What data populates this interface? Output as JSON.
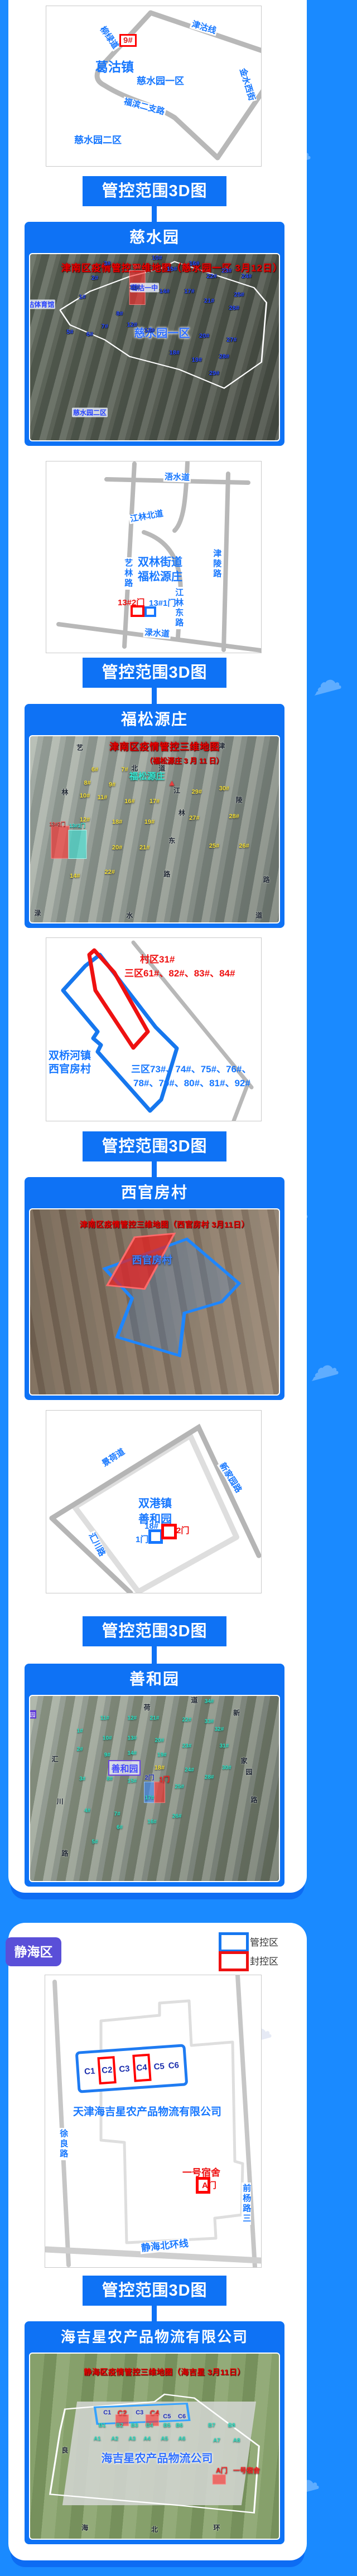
{
  "banner_label": "管控范围3D图",
  "watermark_text": "津云",
  "jinghai": {
    "badge": "静海区",
    "legend": [
      {
        "label": "管控区",
        "color": "#1677f0"
      },
      {
        "label": "封控区",
        "color": "#ee1111"
      }
    ]
  },
  "map1": {
    "marker": "9#",
    "town": "葛沽镇",
    "area1": "慈水园一区",
    "area2": "慈水园二区",
    "road_liulv": "柳绿道",
    "road_jingu": "津沽线",
    "road_jinshui": "金水西街",
    "road_fubin": "福滨二支路"
  },
  "sat1": {
    "title": "慈水园",
    "marks": [
      {
        "t": "津南区疫情管控三维地图（慈水园一区 3月12日）",
        "x": 57,
        "y": 7,
        "c": "headline"
      },
      {
        "t": "",
        "x": 43,
        "y": 18,
        "w": 6,
        "h": 18,
        "c": "hl-red"
      },
      {
        "t": "9#",
        "x": 43,
        "y": 7,
        "c": "num-red"
      },
      {
        "t": "葛沽一中",
        "x": 46,
        "y": 18,
        "c": "tag-blue"
      },
      {
        "t": "葛沽体育馆",
        "x": 3,
        "y": 27,
        "c": "tag-blue"
      },
      {
        "t": "慈水园一区",
        "x": 53,
        "y": 42,
        "c": "big-blue"
      },
      {
        "t": "慈水园二区",
        "x": 24,
        "y": 85,
        "c": "tag-blue"
      },
      {
        "t": "1#",
        "x": 21,
        "y": 23,
        "c": "num-blue"
      },
      {
        "t": "2#",
        "x": 26,
        "y": 13,
        "c": "num-blue"
      },
      {
        "t": "3#",
        "x": 31,
        "y": 5,
        "c": "num-blue"
      },
      {
        "t": "5#",
        "x": 16,
        "y": 42,
        "c": "num-blue"
      },
      {
        "t": "6#",
        "x": 24,
        "y": 43,
        "c": "num-blue"
      },
      {
        "t": "7#",
        "x": 30,
        "y": 39,
        "c": "num-blue"
      },
      {
        "t": "8#",
        "x": 36,
        "y": 32,
        "c": "num-blue"
      },
      {
        "t": "10#",
        "x": 51,
        "y": 2,
        "c": "num-blue"
      },
      {
        "t": "11#",
        "x": 42,
        "y": 18,
        "c": "num-blue"
      },
      {
        "t": "12#",
        "x": 41,
        "y": 38,
        "c": "num-blue"
      },
      {
        "t": "13#",
        "x": 48,
        "y": 41,
        "c": "num-blue"
      },
      {
        "t": "14#",
        "x": 54,
        "y": 20,
        "c": "num-blue"
      },
      {
        "t": "15#",
        "x": 57,
        "y": 8,
        "c": "num-blue"
      },
      {
        "t": "16#",
        "x": 66,
        "y": 5,
        "c": "num-blue"
      },
      {
        "t": "17#",
        "x": 64,
        "y": 20,
        "c": "num-blue"
      },
      {
        "t": "18#",
        "x": 58,
        "y": 53,
        "c": "num-blue"
      },
      {
        "t": "19#",
        "x": 67,
        "y": 57,
        "c": "num-blue"
      },
      {
        "t": "20#",
        "x": 70,
        "y": 44,
        "c": "num-blue"
      },
      {
        "t": "21#",
        "x": 72,
        "y": 25,
        "c": "num-blue"
      },
      {
        "t": "22#",
        "x": 73,
        "y": 12,
        "c": "num-blue"
      },
      {
        "t": "23#",
        "x": 79,
        "y": 9,
        "c": "num-blue"
      },
      {
        "t": "24#",
        "x": 87,
        "y": 12,
        "c": "num-blue"
      },
      {
        "t": "25#",
        "x": 84,
        "y": 22,
        "c": "num-blue"
      },
      {
        "t": "26#",
        "x": 82,
        "y": 29,
        "c": "num-blue"
      },
      {
        "t": "27#",
        "x": 81,
        "y": 46,
        "c": "num-blue"
      },
      {
        "t": "28#",
        "x": 78,
        "y": 55,
        "c": "num-blue"
      },
      {
        "t": "29#",
        "x": 74,
        "y": 64,
        "c": "num-blue"
      }
    ]
  },
  "map2": {
    "road_wushui": "浯水道",
    "road_yilin": "艺林路",
    "road_jinling": "津陵路",
    "road_jldong": "江林东路",
    "road_jlbei": "江林北道",
    "road_lushui": "渌水道",
    "name1": "双林街道",
    "name2": "福松源庄",
    "gate2": "13#2门",
    "gate1": "13#1门"
  },
  "sat2": {
    "title": "福松源庄",
    "marks": [
      {
        "t": "津南区疫情管控三维地图",
        "x": 54,
        "y": 5,
        "c": "headline"
      },
      {
        "t": "（福松源庄 3 月 11 日）",
        "x": 62,
        "y": 13,
        "c": "headline2"
      },
      {
        "t": "福松源庄",
        "x": 47,
        "y": 21,
        "c": "big-teal"
      },
      {
        "t": "",
        "x": 12,
        "y": 57,
        "w": 7,
        "h": 17,
        "c": "hl-red"
      },
      {
        "t": "",
        "x": 19,
        "y": 58,
        "w": 7,
        "h": 15,
        "c": "hl-cyan"
      },
      {
        "t": "13#2门",
        "x": 11,
        "y": 47,
        "c": "tiny-red"
      },
      {
        "t": "13#1门",
        "x": 19,
        "y": 48,
        "c": "tiny-cyan"
      },
      {
        "t": "6#",
        "x": 26,
        "y": 18,
        "c": "num-yellow"
      },
      {
        "t": "7#",
        "x": 38,
        "y": 18,
        "c": "num-yellow"
      },
      {
        "t": "8#",
        "x": 23,
        "y": 25,
        "c": "num-yellow"
      },
      {
        "t": "9#",
        "x": 33,
        "y": 26,
        "c": "num-yellow"
      },
      {
        "t": "10#",
        "x": 22,
        "y": 32,
        "c": "num-yellow"
      },
      {
        "t": "11#",
        "x": 29,
        "y": 33,
        "c": "num-yellow"
      },
      {
        "t": "16#",
        "x": 40,
        "y": 35,
        "c": "num-yellow"
      },
      {
        "t": "17#",
        "x": 50,
        "y": 35,
        "c": "num-yellow"
      },
      {
        "t": "29#",
        "x": 67,
        "y": 30,
        "c": "num-yellow"
      },
      {
        "t": "30#",
        "x": 78,
        "y": 28,
        "c": "num-yellow"
      },
      {
        "t": "12#",
        "x": 22,
        "y": 45,
        "c": "num-yellow"
      },
      {
        "t": "18#",
        "x": 35,
        "y": 46,
        "c": "num-yellow"
      },
      {
        "t": "19#",
        "x": 48,
        "y": 46,
        "c": "num-yellow"
      },
      {
        "t": "27#",
        "x": 66,
        "y": 44,
        "c": "num-yellow"
      },
      {
        "t": "28#",
        "x": 82,
        "y": 43,
        "c": "num-yellow"
      },
      {
        "t": "20#",
        "x": 35,
        "y": 60,
        "c": "num-yellow"
      },
      {
        "t": "21#",
        "x": 46,
        "y": 60,
        "c": "num-yellow"
      },
      {
        "t": "25#",
        "x": 74,
        "y": 59,
        "c": "num-yellow"
      },
      {
        "t": "26#",
        "x": 86,
        "y": 59,
        "c": "num-yellow"
      },
      {
        "t": "22#",
        "x": 32,
        "y": 73,
        "c": "num-yellow"
      },
      {
        "t": "14#",
        "x": 18,
        "y": 75,
        "c": "num-yellow"
      },
      {
        "t": "艺",
        "x": 20,
        "y": 6,
        "c": "rchar"
      },
      {
        "t": "林",
        "x": 14,
        "y": 30,
        "c": "rchar"
      },
      {
        "t": "北",
        "x": 42,
        "y": 17,
        "c": "rchar"
      },
      {
        "t": "道",
        "x": 53,
        "y": 17,
        "c": "rchar"
      },
      {
        "t": "江",
        "x": 59,
        "y": 29,
        "c": "rchar"
      },
      {
        "t": "林",
        "x": 61,
        "y": 41,
        "c": "rchar"
      },
      {
        "t": "东",
        "x": 57,
        "y": 56,
        "c": "rchar"
      },
      {
        "t": "路",
        "x": 55,
        "y": 74,
        "c": "rchar"
      },
      {
        "t": "津",
        "x": 77,
        "y": 5,
        "c": "rchar"
      },
      {
        "t": "陵",
        "x": 84,
        "y": 34,
        "c": "rchar"
      },
      {
        "t": "路",
        "x": 95,
        "y": 77,
        "c": "rchar"
      },
      {
        "t": "渌",
        "x": 3,
        "y": 95,
        "c": "rchar"
      },
      {
        "t": "水",
        "x": 40,
        "y": 96,
        "c": "rchar"
      },
      {
        "t": "道",
        "x": 92,
        "y": 96,
        "c": "rchar"
      }
    ]
  },
  "map3": {
    "red1": "村区31#",
    "red2": "三区61#、82#、83#、84#",
    "name1": "双桥河镇",
    "name2": "西官房村",
    "blue1": "三区73#、74#、75#、76#、",
    "blue2": "78#、79#、80#、81#、92#"
  },
  "sat3": {
    "title": "西官房村",
    "marks": [
      {
        "t": "津南区疫情管控三维地图（西官房村 3月11日）",
        "x": 54,
        "y": 8,
        "c": "headline-sm"
      },
      {
        "t": "西官房村",
        "x": 49,
        "y": 27,
        "c": "big-blue2"
      }
    ]
  },
  "map4": {
    "road_jinghe": "景荷道",
    "road_xinjiayuan": "新家园路",
    "road_huichuan": "汇川路",
    "name1": "双港镇",
    "name2": "善和园",
    "bldg": "18#",
    "gate1": "1门",
    "gate2": "2门"
  },
  "sat4": {
    "title": "善和园",
    "marks": [
      {
        "t": "园",
        "x": 1,
        "y": 10,
        "c": "tag-purple"
      },
      {
        "t": "善和园",
        "x": 38,
        "y": 39,
        "c": "big-purple"
      },
      {
        "t": "18#",
        "x": 52,
        "y": 39,
        "c": "num-yellow"
      },
      {
        "t": "",
        "x": 48,
        "y": 52,
        "w": 4,
        "h": 11,
        "c": "hl-blue"
      },
      {
        "t": "",
        "x": 52,
        "y": 52,
        "w": 4,
        "h": 11,
        "c": "hl-red"
      },
      {
        "t": "2门",
        "x": 48,
        "y": 44,
        "c": "num-navy"
      },
      {
        "t": "1门",
        "x": 54,
        "y": 45,
        "c": "num-redsm"
      },
      {
        "t": "1#",
        "x": 20,
        "y": 19,
        "c": "num-teal"
      },
      {
        "t": "2#",
        "x": 20,
        "y": 29,
        "c": "num-teal"
      },
      {
        "t": "3#",
        "x": 21,
        "y": 45,
        "c": "num-teal"
      },
      {
        "t": "4#",
        "x": 23,
        "y": 62,
        "c": "num-teal"
      },
      {
        "t": "5#",
        "x": 26,
        "y": 79,
        "c": "num-teal"
      },
      {
        "t": "6#",
        "x": 36,
        "y": 71,
        "c": "num-teal"
      },
      {
        "t": "7#",
        "x": 35,
        "y": 64,
        "c": "num-teal"
      },
      {
        "t": "8#",
        "x": 32,
        "y": 45,
        "c": "num-teal"
      },
      {
        "t": "9#",
        "x": 31,
        "y": 32,
        "c": "num-teal"
      },
      {
        "t": "10#",
        "x": 31,
        "y": 23,
        "c": "num-teal"
      },
      {
        "t": "11#",
        "x": 30,
        "y": 12,
        "c": "num-teal"
      },
      {
        "t": "12#",
        "x": 41,
        "y": 12,
        "c": "num-teal"
      },
      {
        "t": "13#",
        "x": 41,
        "y": 23,
        "c": "num-teal"
      },
      {
        "t": "14#",
        "x": 41,
        "y": 31,
        "c": "num-teal"
      },
      {
        "t": "15#",
        "x": 41,
        "y": 46,
        "c": "num-teal"
      },
      {
        "t": "16#",
        "x": 49,
        "y": 68,
        "c": "num-teal"
      },
      {
        "t": "17#",
        "x": 48,
        "y": 55,
        "c": "num-teal"
      },
      {
        "t": "19#",
        "x": 53,
        "y": 32,
        "c": "num-teal"
      },
      {
        "t": "20#",
        "x": 52,
        "y": 24,
        "c": "num-teal"
      },
      {
        "t": "21#",
        "x": 50,
        "y": 12,
        "c": "num-teal"
      },
      {
        "t": "22#",
        "x": 63,
        "y": 13,
        "c": "num-teal"
      },
      {
        "t": "23#",
        "x": 63,
        "y": 27,
        "c": "num-teal"
      },
      {
        "t": "24#",
        "x": 64,
        "y": 40,
        "c": "num-teal"
      },
      {
        "t": "25#",
        "x": 60,
        "y": 49,
        "c": "num-teal"
      },
      {
        "t": "26#",
        "x": 59,
        "y": 65,
        "c": "num-teal"
      },
      {
        "t": "28#",
        "x": 72,
        "y": 44,
        "c": "num-teal"
      },
      {
        "t": "30#",
        "x": 79,
        "y": 39,
        "c": "num-teal"
      },
      {
        "t": "31#",
        "x": 78,
        "y": 27,
        "c": "num-teal"
      },
      {
        "t": "32#",
        "x": 76,
        "y": 18,
        "c": "num-teal"
      },
      {
        "t": "33#",
        "x": 72,
        "y": 14,
        "c": "num-teal"
      },
      {
        "t": "34#",
        "x": 72,
        "y": 3,
        "c": "num-teal"
      },
      {
        "t": "汇",
        "x": 10,
        "y": 34,
        "c": "rchar"
      },
      {
        "t": "川",
        "x": 12,
        "y": 57,
        "c": "rchar"
      },
      {
        "t": "路",
        "x": 14,
        "y": 85,
        "c": "rchar"
      },
      {
        "t": "荷",
        "x": 47,
        "y": 6,
        "c": "rchar"
      },
      {
        "t": "道",
        "x": 66,
        "y": 2,
        "c": "rchar"
      },
      {
        "t": "新",
        "x": 83,
        "y": 9,
        "c": "rchar"
      },
      {
        "t": "家",
        "x": 86,
        "y": 35,
        "c": "rchar"
      },
      {
        "t": "园",
        "x": 88,
        "y": 41,
        "c": "rchar"
      },
      {
        "t": "路",
        "x": 90,
        "y": 56,
        "c": "rchar"
      }
    ]
  },
  "map5": {
    "c_labels": [
      "C1",
      "C2",
      "C3",
      "C4",
      "C5",
      "C6"
    ],
    "company": "天津海吉星农产品物流有限公司",
    "road_xuliang": "徐良路",
    "road_qianyang": "前杨路三",
    "road_beihuan": "静海北环线",
    "dorm": "一号宿舍",
    "gate": "A门"
  },
  "sat5": {
    "title": "海吉星农产品物流有限公司",
    "marks": [
      {
        "t": "静海区疫情管控三维地图（海吉星 3月11日）",
        "x": 54,
        "y": 10,
        "c": "headline-sm"
      },
      {
        "t": "C1",
        "x": 31,
        "y": 32,
        "c": "num-navy"
      },
      {
        "t": "C2",
        "x": 37,
        "y": 32,
        "c": "num-red"
      },
      {
        "t": "C3",
        "x": 44,
        "y": 32,
        "c": "num-navy"
      },
      {
        "t": "C4",
        "x": 50,
        "y": 32,
        "c": "num-red"
      },
      {
        "t": "C5",
        "x": 55,
        "y": 34,
        "c": "num-navy"
      },
      {
        "t": "C6",
        "x": 61,
        "y": 34,
        "c": "num-navy"
      },
      {
        "t": "",
        "x": 37,
        "y": 36,
        "w": 5,
        "h": 6,
        "c": "hl-red"
      },
      {
        "t": "",
        "x": 49,
        "y": 36,
        "w": 5,
        "h": 6,
        "c": "hl-red"
      },
      {
        "t": "B1",
        "x": 29,
        "y": 39,
        "c": "num-teal"
      },
      {
        "t": "B2",
        "x": 36,
        "y": 39,
        "c": "num-teal"
      },
      {
        "t": "B3",
        "x": 42,
        "y": 39,
        "c": "num-teal"
      },
      {
        "t": "B4",
        "x": 48,
        "y": 39,
        "c": "num-teal"
      },
      {
        "t": "B5",
        "x": 55,
        "y": 39,
        "c": "num-teal"
      },
      {
        "t": "B6",
        "x": 60,
        "y": 39,
        "c": "num-teal"
      },
      {
        "t": "B7",
        "x": 73,
        "y": 39,
        "c": "num-teal"
      },
      {
        "t": "B8",
        "x": 81,
        "y": 39,
        "c": "num-teal"
      },
      {
        "t": "A1",
        "x": 27,
        "y": 46,
        "c": "num-teal"
      },
      {
        "t": "A2",
        "x": 34,
        "y": 46,
        "c": "num-teal"
      },
      {
        "t": "A3",
        "x": 41,
        "y": 46,
        "c": "num-teal"
      },
      {
        "t": "A4",
        "x": 47,
        "y": 46,
        "c": "num-teal"
      },
      {
        "t": "A5",
        "x": 54,
        "y": 46,
        "c": "num-teal"
      },
      {
        "t": "A6",
        "x": 61,
        "y": 46,
        "c": "num-teal"
      },
      {
        "t": "A7",
        "x": 75,
        "y": 47,
        "c": "num-teal"
      },
      {
        "t": "A8",
        "x": 83,
        "y": 47,
        "c": "num-teal"
      },
      {
        "t": "海吉星农产品物流公司",
        "x": 51,
        "y": 56,
        "c": "big-blue"
      },
      {
        "t": "A门",
        "x": 77,
        "y": 63,
        "c": "num-redsm"
      },
      {
        "t": "一号宿舍",
        "x": 87,
        "y": 63,
        "c": "num-redsm"
      },
      {
        "t": "",
        "x": 76,
        "y": 68,
        "w": 5,
        "h": 5,
        "c": "hl-red"
      },
      {
        "t": "良",
        "x": 14,
        "y": 52,
        "c": "rchar"
      },
      {
        "t": "海",
        "x": 22,
        "y": 94,
        "c": "rchar"
      },
      {
        "t": "北",
        "x": 50,
        "y": 95,
        "c": "rchar"
      },
      {
        "t": "环",
        "x": 75,
        "y": 94,
        "c": "rchar"
      }
    ]
  }
}
